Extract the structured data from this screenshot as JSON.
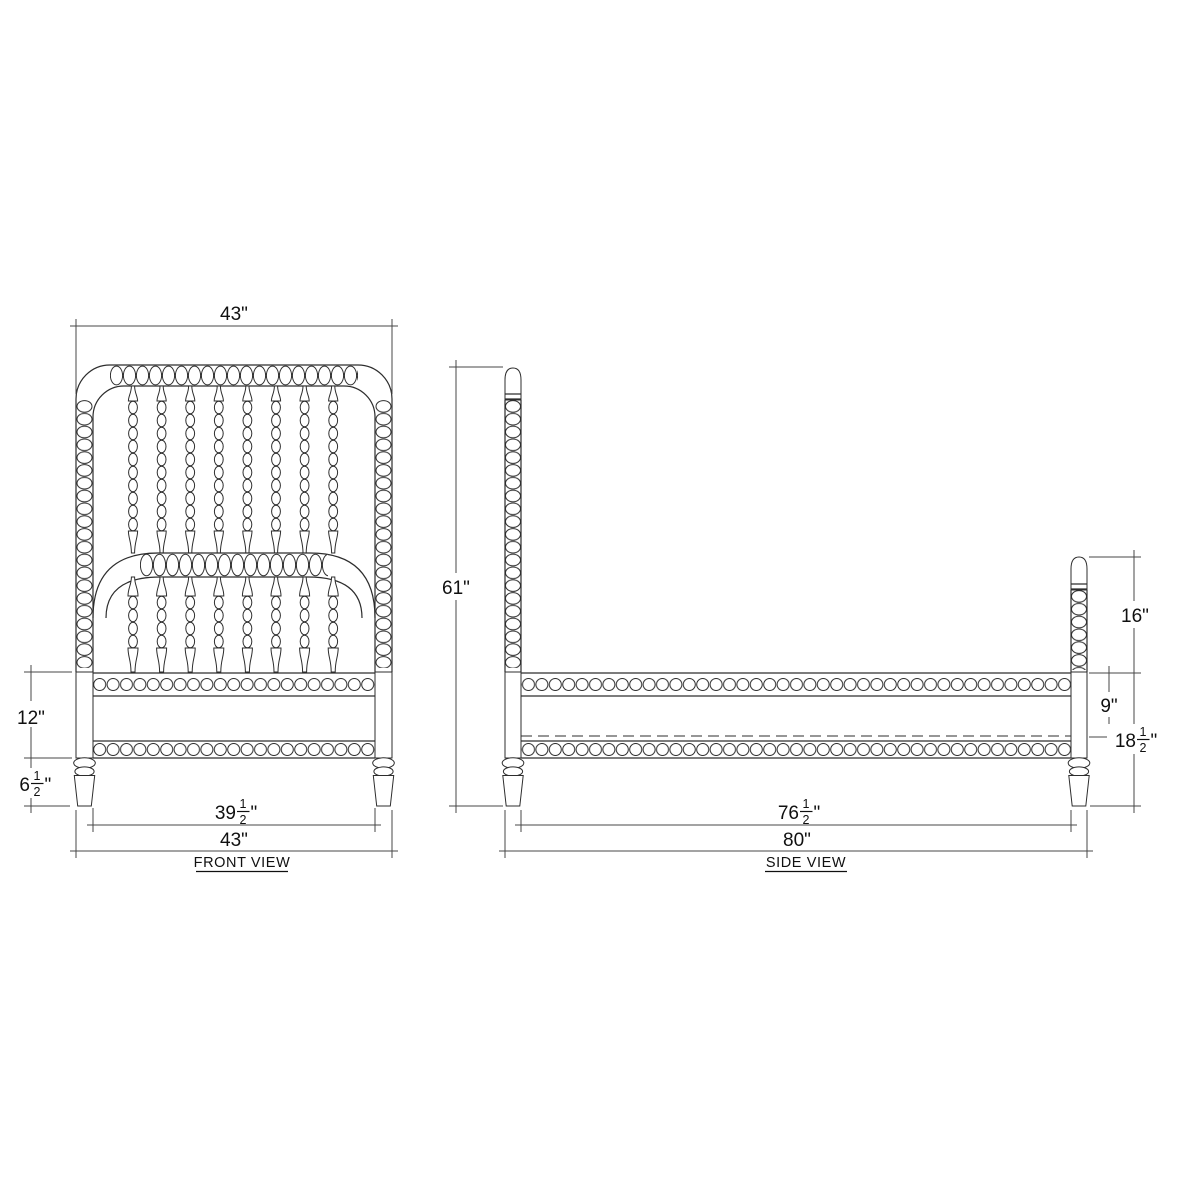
{
  "drawing": {
    "type": "furniture-technical-drawing",
    "subject": "spindle-spool-bed",
    "units": "inches",
    "line_color": "#2d2d2d",
    "dim_line_color": "#474747",
    "background": "#ffffff"
  },
  "front_view": {
    "title": "FRONT VIEW",
    "dim_width_top": "43\"",
    "dim_rail_height": "12\"",
    "dim_leg": {
      "whole": "6",
      "num": "1",
      "den": "2",
      "unit": "\""
    },
    "dim_inner_width": {
      "whole": "39",
      "num": "1",
      "den": "2",
      "unit": "\""
    },
    "dim_width_bottom": "43\""
  },
  "side_view": {
    "title": "SIDE VIEW",
    "dim_total_height": "61\"",
    "dim_post_above_rail": "16\"",
    "dim_rail_to_support": "9\"",
    "dim_rail_floor": {
      "whole": "18",
      "num": "1",
      "den": "2",
      "unit": "\""
    },
    "dim_inner_length": {
      "whole": "76",
      "num": "1",
      "den": "2",
      "unit": "\""
    },
    "dim_total_length": "80\""
  }
}
